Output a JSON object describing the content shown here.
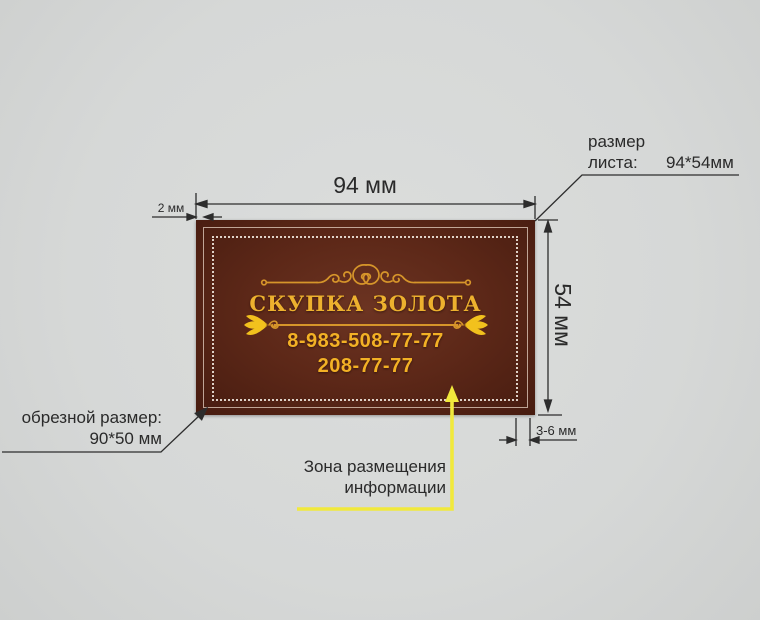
{
  "page": {
    "background": "#d6d8d7"
  },
  "card": {
    "title": "СКУПКА ЗОЛОТА",
    "phone_primary": "8-983-508-77-77",
    "phone_secondary": "208-77-77",
    "colors": {
      "body_center": "#6c3422",
      "body_edge": "#471c10",
      "gold_title": "#edb12e",
      "gold_phone": "#f3b125",
      "ornament_gold": "#d6952a",
      "fleur_gold": "#f2c11d",
      "inner_border": "rgba(236,216,201,0.72)",
      "dotted_border": "rgba(247,240,231,0.85)"
    }
  },
  "dimensions": {
    "sheet_width": "94 мм",
    "sheet_height": "54 мм",
    "bleed": "2 мм",
    "safe_margin": "3-6 мм"
  },
  "callouts": {
    "sheet_size": {
      "label_line1": "размер",
      "label_line2": "листа:",
      "value": "94*54мм"
    },
    "trim_size": {
      "label": "обрезной размер:",
      "value": "90*50 мм"
    },
    "info_zone": {
      "label": "Зона размещения\nинформации"
    }
  },
  "colors": {
    "measure_line": "#2d2d2d",
    "text": "#2a2a2a",
    "zone_arrow_yellow": "#f1e93c"
  }
}
